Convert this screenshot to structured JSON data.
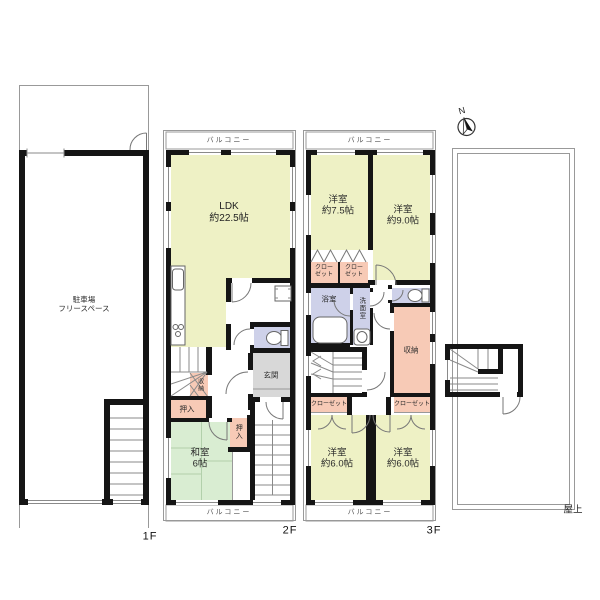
{
  "compass": {
    "label": "N"
  },
  "floor1": {
    "label": "1F",
    "parking_line1": "駐車場",
    "parking_line2": "フリースペース"
  },
  "floor2": {
    "label": "2F",
    "balcony_top": "バルコニー",
    "balcony_bottom": "バルコニー",
    "ldk_line1": "LDK",
    "ldk_line2": "約22.5帖",
    "genkan": "玄関",
    "storage_understairs": "収納",
    "oshiire": "押入",
    "oshiire_small": "押入",
    "washitsu_line1": "和室",
    "washitsu_line2": "6帖"
  },
  "floor3": {
    "label": "3F",
    "balcony_top": "バルコニー",
    "balcony_bottom": "バルコニー",
    "room_75_line1": "洋室",
    "room_75_line2": "約7.5帖",
    "room_90_line1": "洋室",
    "room_90_line2": "約9.0帖",
    "room_60a_line1": "洋室",
    "room_60a_line2": "約6.0帖",
    "room_60b_line1": "洋室",
    "room_60b_line2": "約6.0帖",
    "closet_a_line1": "クロー",
    "closet_a_line2": "ゼット",
    "closet_b_line1": "クロー",
    "closet_b_line2": "ゼット",
    "bathroom": "浴室",
    "washroom": "洗面室",
    "storage": "収納",
    "closet_c": "クローゼット",
    "closet_d": "クローゼット"
  },
  "roof": {
    "label": "屋上"
  },
  "colors": {
    "room_yellow": "#eef1c5",
    "tatami_green": "#d9edd2",
    "closet_pink": "#f7cab6",
    "wet_purple": "#ced1e9",
    "genkan_gray": "#d8d8d8",
    "balcony_gray": "#e7e7e7"
  }
}
